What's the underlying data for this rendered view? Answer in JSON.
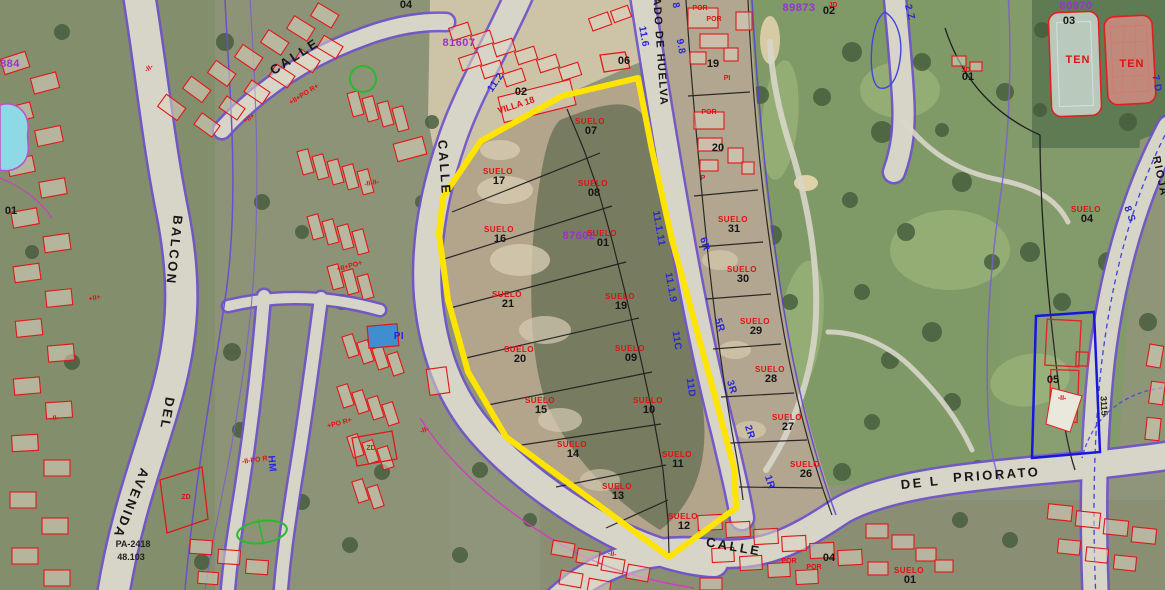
{
  "map": {
    "colors": {
      "boundary_yellow": "#ffe400",
      "cadastral_red": "#e01818",
      "annotation_blue": "#2828d8",
      "code_purple": "#9933cc",
      "boundary_violet": "#6f52cc",
      "golf_green": "#7f9a66",
      "dirt_tan": "#b3a48c",
      "road_grey": "#d7d4c8"
    },
    "labels": [
      {
        "t": "CALLE",
        "x": 297,
        "y": 60,
        "r": -33,
        "c": "street",
        "n": "street-calle-nw"
      },
      {
        "t": "CALLE",
        "x": 440,
        "y": 168,
        "r": 86,
        "c": "street",
        "n": "street-calle-center"
      },
      {
        "t": "BALCON",
        "x": 170,
        "y": 250,
        "r": 96,
        "c": "street",
        "n": "street-balcon"
      },
      {
        "t": "DEL",
        "x": 163,
        "y": 413,
        "r": 100,
        "c": "street",
        "n": "street-del"
      },
      {
        "t": "AVENIDA",
        "x": 127,
        "y": 502,
        "r": 112,
        "c": "street",
        "n": "street-avenida"
      },
      {
        "t": "CALLE",
        "x": 733,
        "y": 551,
        "r": 10,
        "c": "street",
        "n": "street-calle-south"
      },
      {
        "t": "DE L",
        "x": 921,
        "y": 487,
        "r": -6,
        "c": "street",
        "n": "street-del-priorato-1"
      },
      {
        "t": "PRIORATO",
        "x": 997,
        "y": 479,
        "r": -4,
        "c": "street",
        "n": "street-del-priorato-2"
      },
      {
        "t": "ADO DE HUELVA",
        "x": 657,
        "y": 52,
        "r": 86,
        "c": "streetsm",
        "n": "street-huelva"
      },
      {
        "t": "RIOJA",
        "x": 1157,
        "y": 177,
        "r": 78,
        "c": "streetsm",
        "n": "street-rioja"
      },
      {
        "t": "PA-2418",
        "x": 133,
        "y": 547,
        "r": 0,
        "c": "tinydark",
        "n": "ref-pa-2418"
      },
      {
        "t": "48.103",
        "x": 131,
        "y": 560,
        "r": 0,
        "c": "tinydark",
        "n": "ref-48-103"
      },
      {
        "t": "3115",
        "x": 1101,
        "y": 406,
        "r": 87,
        "c": "tinydark",
        "n": "ref-3115"
      },
      {
        "t": "VILLA 18",
        "x": 517,
        "y": 108,
        "r": -18,
        "c": "villa",
        "n": "label-villa-18"
      },
      {
        "t": "04",
        "x": 406,
        "y": 8,
        "r": 0,
        "c": "num",
        "n": "parcel-04-nw"
      },
      {
        "t": "02",
        "x": 521,
        "y": 95,
        "r": 0,
        "c": "num",
        "n": "parcel-02-villa"
      },
      {
        "t": "06",
        "x": 624,
        "y": 64,
        "r": 0,
        "c": "num",
        "n": "parcel-06"
      },
      {
        "t": "19",
        "x": 713,
        "y": 67,
        "r": 0,
        "c": "num",
        "n": "parcel-19"
      },
      {
        "t": "20",
        "x": 718,
        "y": 151,
        "r": 0,
        "c": "num",
        "n": "parcel-20"
      },
      {
        "t": "02",
        "x": 829,
        "y": 14,
        "r": 0,
        "c": "num",
        "n": "parcel-02-golf"
      },
      {
        "t": "01",
        "x": 968,
        "y": 80,
        "r": 0,
        "c": "num",
        "n": "parcel-01-golf"
      },
      {
        "t": "03",
        "x": 1069,
        "y": 24,
        "r": 0,
        "c": "num",
        "n": "parcel-03-tennis"
      },
      {
        "t": "05",
        "x": 1053,
        "y": 383,
        "r": 0,
        "c": "num",
        "n": "parcel-05-east"
      },
      {
        "t": "01",
        "x": 11,
        "y": 214,
        "r": 0,
        "c": "num",
        "n": "parcel-01-west"
      },
      {
        "t": "04",
        "x": 829,
        "y": 561,
        "r": 0,
        "c": "num",
        "n": "parcel-04-se"
      },
      {
        "t": "POR",
        "x": 700,
        "y": 10,
        "r": 0,
        "c": "redsm",
        "n": "bldg-code-por"
      },
      {
        "t": "POR",
        "x": 714,
        "y": 21,
        "r": 0,
        "c": "redsm",
        "n": "bldg-code-por"
      },
      {
        "t": "POR",
        "x": 709,
        "y": 114,
        "r": 0,
        "c": "redsm",
        "n": "bldg-code-por"
      },
      {
        "t": "PI",
        "x": 727,
        "y": 80,
        "r": 0,
        "c": "redsm",
        "n": "bldg-code-pi"
      },
      {
        "t": "P",
        "x": 703,
        "y": 180,
        "r": 0,
        "c": "redsm",
        "n": "bldg-code-p"
      },
      {
        "t": "JD",
        "x": 833,
        "y": 7,
        "r": 0,
        "c": "redsm",
        "n": "bldg-code-jd"
      },
      {
        "t": "JD",
        "x": 966,
        "y": 72,
        "r": 0,
        "c": "redsm",
        "n": "bldg-code-jd"
      },
      {
        "t": "ZD",
        "x": 186,
        "y": 499,
        "r": 0,
        "c": "redsm",
        "n": "bldg-code-zd"
      },
      {
        "t": "ZD",
        "x": 371,
        "y": 450,
        "r": 0,
        "c": "redsm",
        "n": "bldg-code-zd"
      },
      {
        "t": "POR",
        "x": 789,
        "y": 563,
        "r": 0,
        "c": "redsm",
        "n": "bldg-code-por"
      },
      {
        "t": "POR",
        "x": 814,
        "y": 569,
        "r": 0,
        "c": "redsm",
        "n": "bldg-code-por"
      },
      {
        "t": "+II+PO R+",
        "x": 305,
        "y": 96,
        "r": -32,
        "c": "redsm",
        "n": "bldg-code-ii"
      },
      {
        "t": "-II-II-",
        "x": 372,
        "y": 185,
        "r": -10,
        "c": "redsm",
        "n": "bldg-code-ii"
      },
      {
        "t": "+II+PO+",
        "x": 350,
        "y": 268,
        "r": -15,
        "c": "redsm",
        "n": "bldg-code-ii"
      },
      {
        "t": "-II-",
        "x": 425,
        "y": 432,
        "r": -20,
        "c": "redsm",
        "n": "bldg-code-ii"
      },
      {
        "t": "+II+",
        "x": 95,
        "y": 300,
        "r": -12,
        "c": "redsm",
        "n": "bldg-code-ii"
      },
      {
        "t": "-II-PO R",
        "x": 255,
        "y": 462,
        "r": -8,
        "c": "redsm",
        "n": "bldg-code-ii"
      },
      {
        "t": "-II-",
        "x": 612,
        "y": 556,
        "r": 8,
        "c": "redsm",
        "n": "bldg-code-ii"
      },
      {
        "t": "-II-",
        "x": 1062,
        "y": 400,
        "r": 3,
        "c": "redsm",
        "n": "bldg-code-ii"
      },
      {
        "t": "+II+",
        "x": 250,
        "y": 120,
        "r": -33,
        "c": "redsm",
        "n": "bldg-code-ii"
      },
      {
        "t": "-II-",
        "x": 55,
        "y": 420,
        "r": -10,
        "c": "redsm",
        "n": "bldg-code-ii"
      },
      {
        "t": "+PO R+",
        "x": 340,
        "y": 425,
        "r": -15,
        "c": "redsm",
        "n": "bldg-code-ii"
      },
      {
        "t": "-II-",
        "x": 150,
        "y": 70,
        "r": -35,
        "c": "redsm",
        "n": "bldg-code-ii"
      },
      {
        "t": "TEN",
        "x": 1078,
        "y": 63,
        "r": 0,
        "c": "ten",
        "n": "label-tennis-court-1"
      },
      {
        "t": "TEN",
        "x": 1132,
        "y": 67,
        "r": 0,
        "c": "ten",
        "n": "label-tennis-court-2"
      },
      {
        "t": "11.2",
        "x": 498,
        "y": 84,
        "r": -55,
        "c": "blue",
        "n": "road-dim-11-2"
      },
      {
        "t": "11.6",
        "x": 641,
        "y": 37,
        "r": 80,
        "c": "blue",
        "n": "road-dim-11-6"
      },
      {
        "t": "9.8",
        "x": 678,
        "y": 47,
        "r": 80,
        "c": "blue",
        "n": "road-dim-9-8"
      },
      {
        "t": "8",
        "x": 673,
        "y": 6,
        "r": 80,
        "c": "blue",
        "n": "road-dim-8"
      },
      {
        "t": "11.1.11",
        "x": 656,
        "y": 229,
        "r": 80,
        "c": "blue",
        "n": "road-dim-11-1-11"
      },
      {
        "t": "11.1.9",
        "x": 668,
        "y": 288,
        "r": 80,
        "c": "blue",
        "n": "road-dim-11-1-9"
      },
      {
        "t": "11C",
        "x": 674,
        "y": 341,
        "r": 82,
        "c": "blue",
        "n": "road-code-11c"
      },
      {
        "t": "11D",
        "x": 688,
        "y": 388,
        "r": 82,
        "c": "blue",
        "n": "road-code-11d"
      },
      {
        "t": "6R",
        "x": 702,
        "y": 245,
        "r": 72,
        "c": "blue",
        "n": "road-code-6r"
      },
      {
        "t": "5R",
        "x": 717,
        "y": 326,
        "r": 72,
        "c": "blue",
        "n": "road-code-5r"
      },
      {
        "t": "3R",
        "x": 729,
        "y": 388,
        "r": 72,
        "c": "blue",
        "n": "road-code-3r"
      },
      {
        "t": "2R",
        "x": 747,
        "y": 433,
        "r": 72,
        "c": "blue",
        "n": "road-code-2r"
      },
      {
        "t": "1R",
        "x": 767,
        "y": 483,
        "r": 72,
        "c": "blue",
        "n": "road-code-1r"
      },
      {
        "t": "2 Z",
        "x": 907,
        "y": 13,
        "r": 75,
        "c": "blue",
        "n": "road-code-2z"
      },
      {
        "t": "7 D",
        "x": 1154,
        "y": 84,
        "r": 78,
        "c": "blue",
        "n": "road-code-7d"
      },
      {
        "t": "8 S",
        "x": 1127,
        "y": 215,
        "r": 70,
        "c": "blue",
        "n": "road-code-8s"
      },
      {
        "t": "HM",
        "x": 269,
        "y": 464,
        "r": 85,
        "c": "blue",
        "n": "road-code-hm"
      },
      {
        "t": "PI",
        "x": 399,
        "y": 339,
        "r": 0,
        "c": "blue",
        "n": "pool-code-pi"
      },
      {
        "t": "884",
        "x": 10,
        "y": 67,
        "r": 0,
        "c": "purple",
        "n": "block-code-884"
      },
      {
        "t": "81607",
        "x": 459,
        "y": 46,
        "r": 0,
        "c": "purple",
        "n": "block-code-81607"
      },
      {
        "t": "87602",
        "x": 579,
        "y": 239,
        "r": 0,
        "c": "purple",
        "n": "block-code-87602"
      },
      {
        "t": "89873",
        "x": 799,
        "y": 11,
        "r": 0,
        "c": "purple",
        "n": "block-code-89873"
      },
      {
        "t": "80970",
        "x": 1076,
        "y": 9,
        "r": 0,
        "c": "purple",
        "n": "block-code-80970"
      }
    ],
    "parcels": [
      {
        "word": "SUELO",
        "number": "07",
        "x": 590,
        "y": 124
      },
      {
        "word": "SUELO",
        "number": "17",
        "x": 498,
        "y": 174
      },
      {
        "word": "SUELO",
        "number": "08",
        "x": 593,
        "y": 186
      },
      {
        "word": "SUELO",
        "number": "16",
        "x": 499,
        "y": 232
      },
      {
        "word": "SUELO",
        "number": "01",
        "x": 602,
        "y": 236
      },
      {
        "word": "SUELO",
        "number": "21",
        "x": 507,
        "y": 297
      },
      {
        "word": "SUELO",
        "number": "19",
        "x": 620,
        "y": 299
      },
      {
        "word": "SUELO",
        "number": "20",
        "x": 519,
        "y": 352
      },
      {
        "word": "SUELO",
        "number": "09",
        "x": 630,
        "y": 351
      },
      {
        "word": "SUELO",
        "number": "15",
        "x": 540,
        "y": 403
      },
      {
        "word": "SUELO",
        "number": "10",
        "x": 648,
        "y": 403
      },
      {
        "word": "SUELO",
        "number": "14",
        "x": 572,
        "y": 447
      },
      {
        "word": "SUELO",
        "number": "11",
        "x": 677,
        "y": 457
      },
      {
        "word": "SUELO",
        "number": "13",
        "x": 617,
        "y": 489
      },
      {
        "word": "SUELO",
        "number": "12",
        "x": 683,
        "y": 519
      },
      {
        "word": "SUELO",
        "number": "31",
        "x": 733,
        "y": 222
      },
      {
        "word": "SUELO",
        "number": "30",
        "x": 742,
        "y": 272
      },
      {
        "word": "SUELO",
        "number": "29",
        "x": 755,
        "y": 324
      },
      {
        "word": "SUELO",
        "number": "28",
        "x": 770,
        "y": 372
      },
      {
        "word": "SUELO",
        "number": "27",
        "x": 787,
        "y": 420
      },
      {
        "word": "SUELO",
        "number": "26",
        "x": 805,
        "y": 467
      },
      {
        "word": "SUELO",
        "number": "04",
        "x": 1086,
        "y": 212
      },
      {
        "word": "SUELO",
        "number": "01",
        "x": 909,
        "y": 573
      }
    ]
  }
}
